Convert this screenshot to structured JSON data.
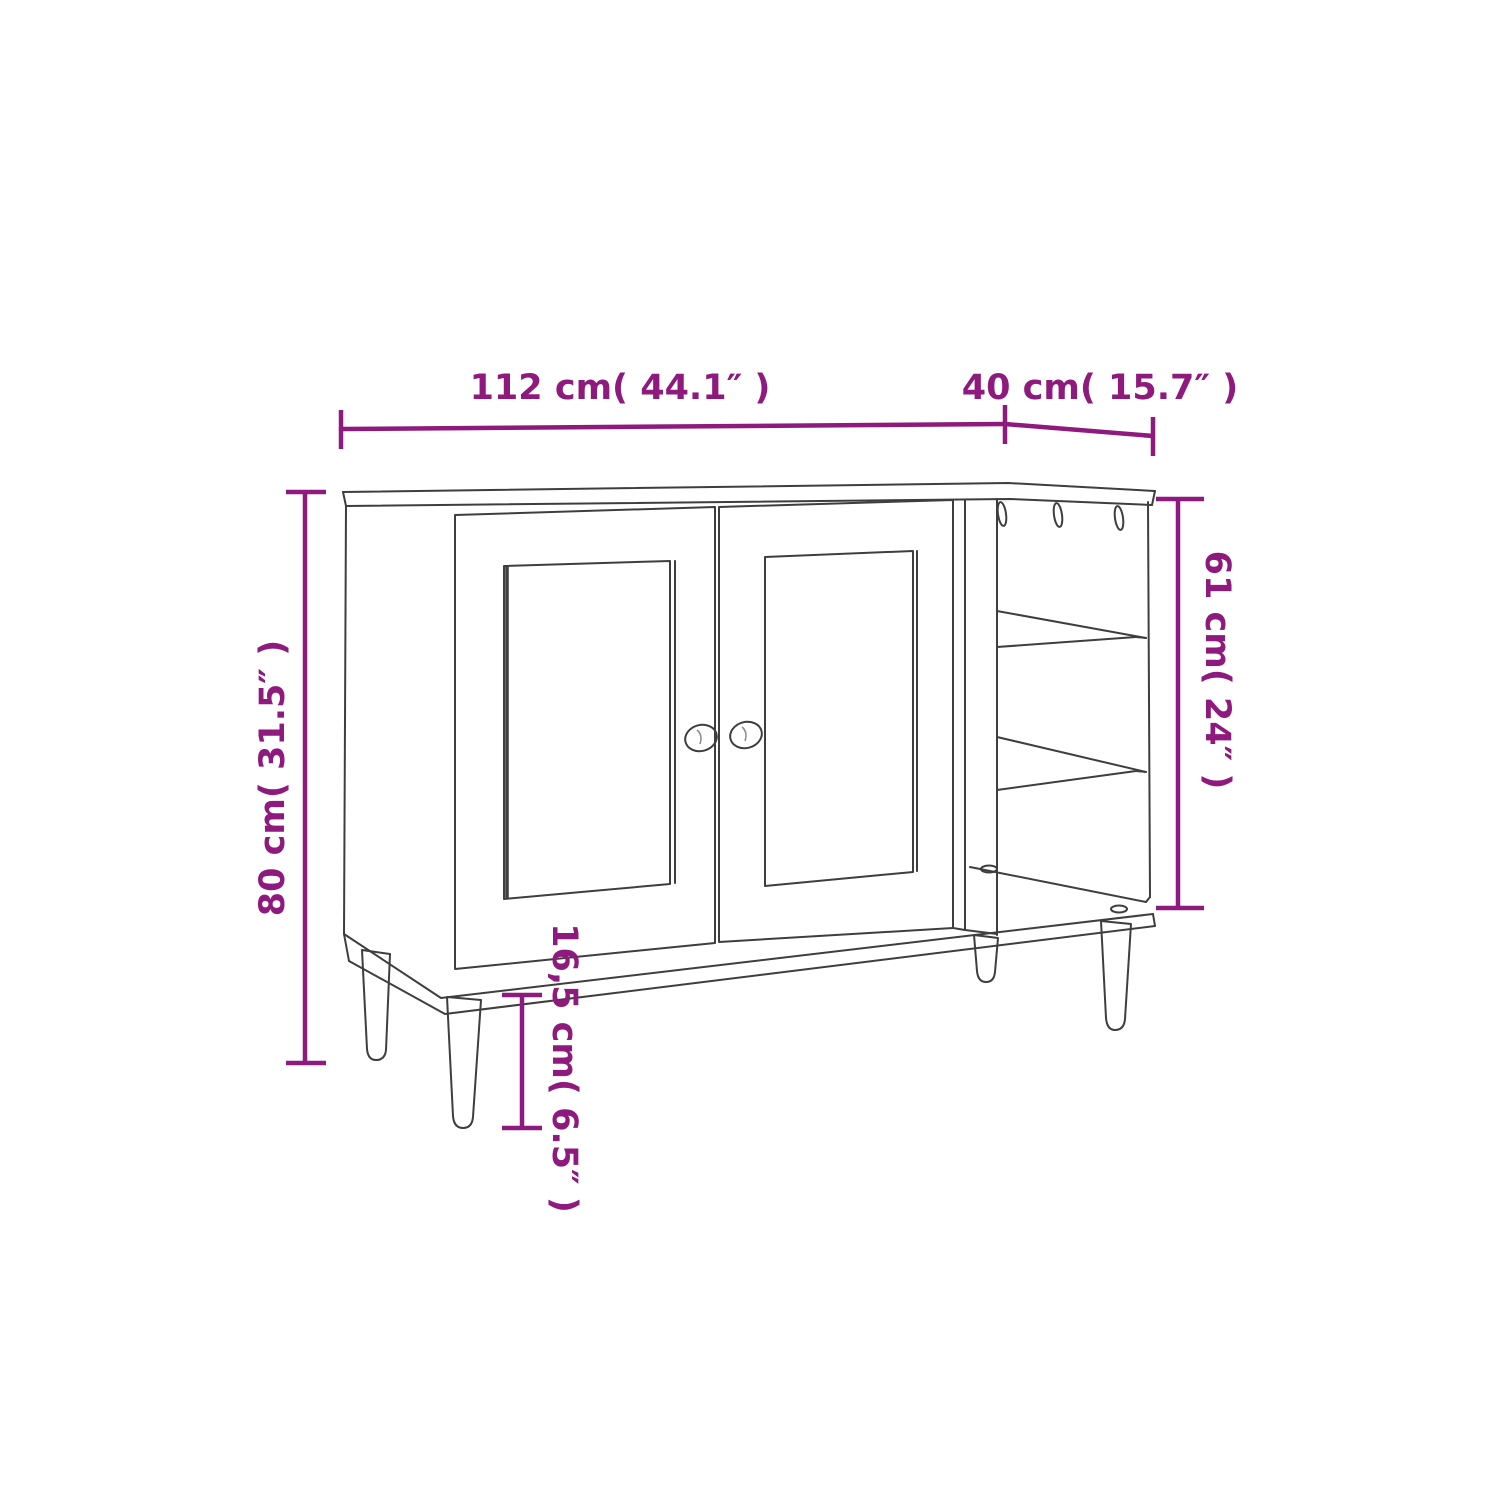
{
  "figure": {
    "background_color": "#ffffff",
    "drawing_line_color": "#3e3e3e",
    "dimension_color": "#8e1a7d",
    "dimensions": [
      {
        "id": "width",
        "label": "112 cm( 44.1″ )",
        "value_cm": "112",
        "value_inch": "44.1",
        "orientation": "horizontal-top-left"
      },
      {
        "id": "depth",
        "label": "40 cm( 15.7″ )",
        "value_cm": "40",
        "value_inch": "15.7",
        "orientation": "horizontal-top-right"
      },
      {
        "id": "height",
        "label": "80 cm( 31.5″ )",
        "value_cm": "80",
        "value_inch": "31.5",
        "orientation": "vertical-left"
      },
      {
        "id": "open_section_height",
        "label": "61 cm( 24″ )",
        "value_cm": "61",
        "value_inch": "24",
        "orientation": "vertical-right"
      },
      {
        "id": "leg_height",
        "label": "16,5 cm( 6.5″ )",
        "value_cm": "16,5",
        "value_inch": "6.5",
        "orientation": "vertical-bottom"
      }
    ]
  }
}
